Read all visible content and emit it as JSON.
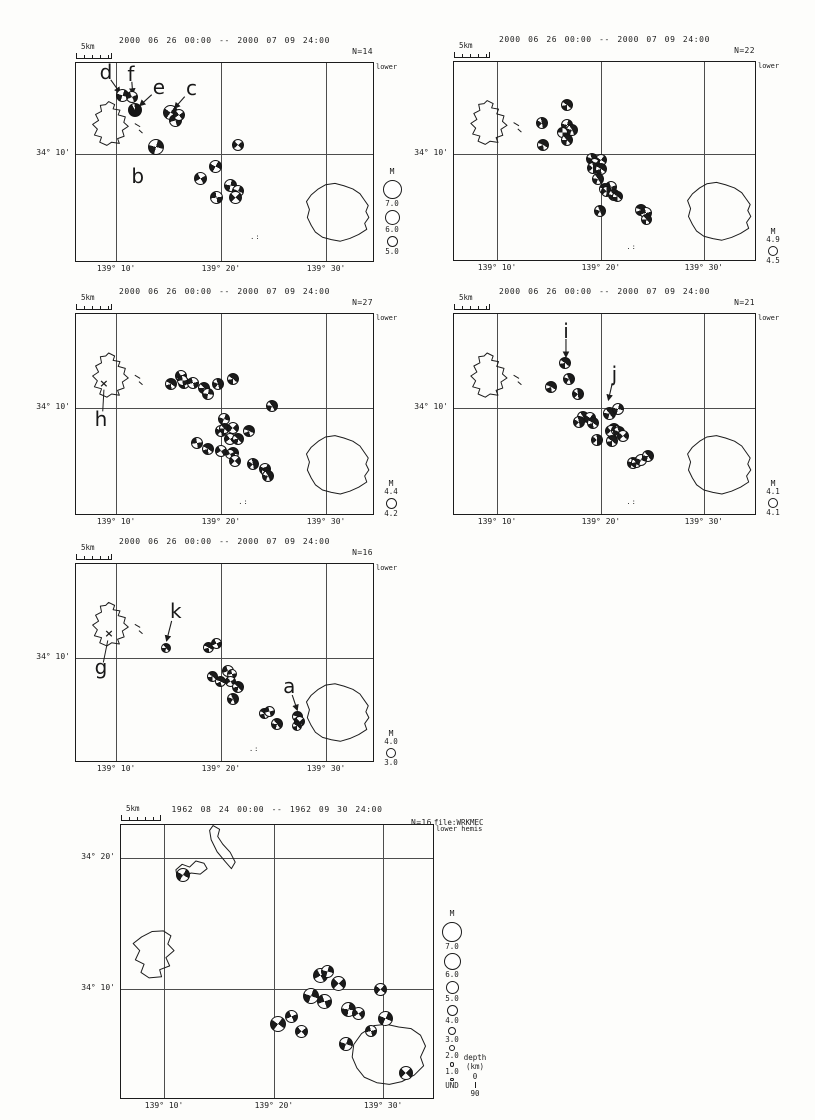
{
  "figure": {
    "ink_color": "#1c1c1c",
    "background_color": "#fdfdfb",
    "events_format": [
      "x_frac_of_frame",
      "y_frac_of_frame",
      "diameter_px",
      "rotation_deg",
      "style"
    ]
  },
  "panels": [
    {
      "id": "p1",
      "title": "2000 06 26 00:00 -- 2000 07 09 24:00",
      "count_label": "N=14",
      "hemisphere_label": "lower",
      "scalebar_label": "5km",
      "xticks": [
        {
          "f": 0.135,
          "label": "139° 10'"
        },
        {
          "f": 0.488,
          "label": "139° 20'"
        },
        {
          "f": 0.842,
          "label": "139° 30'"
        }
      ],
      "yticks": [
        {
          "f": 0.46,
          "label": "34° 10'"
        }
      ],
      "legend": {
        "style": "stack",
        "title": "M",
        "items": [
          {
            "label": "7.0",
            "d": 19
          },
          {
            "label": "6.0",
            "d": 15
          },
          {
            "label": "5.0",
            "d": 11
          }
        ]
      },
      "events": [
        [
          0.158,
          0.165,
          13,
          20,
          "q"
        ],
        [
          0.188,
          0.17,
          12,
          65,
          "q"
        ],
        [
          0.198,
          0.235,
          14,
          10,
          "d"
        ],
        [
          0.319,
          0.25,
          15,
          35,
          "q"
        ],
        [
          0.335,
          0.29,
          13,
          75,
          "q"
        ],
        [
          0.348,
          0.262,
          12,
          55,
          "q"
        ],
        [
          0.268,
          0.425,
          16,
          15,
          "q"
        ],
        [
          0.547,
          0.415,
          12,
          50,
          "q"
        ],
        [
          0.47,
          0.525,
          13,
          28,
          "q"
        ],
        [
          0.419,
          0.585,
          13,
          60,
          "q"
        ],
        [
          0.52,
          0.62,
          13,
          12,
          "q"
        ],
        [
          0.547,
          0.645,
          12,
          25,
          "q"
        ],
        [
          0.473,
          0.68,
          13,
          80,
          "q"
        ],
        [
          0.537,
          0.68,
          13,
          42,
          "q"
        ]
      ],
      "annotations": [
        {
          "letter": "d",
          "x": 0.101,
          "y": 0.05,
          "arrow": [
            0.117,
            0.085,
            0.148,
            0.15
          ]
        },
        {
          "letter": "f",
          "x": 0.185,
          "y": 0.062,
          "arrow": [
            0.188,
            0.095,
            0.191,
            0.155
          ]
        },
        {
          "letter": "e",
          "x": 0.279,
          "y": 0.128,
          "arrow": [
            0.255,
            0.16,
            0.215,
            0.215
          ]
        },
        {
          "letter": "c",
          "x": 0.389,
          "y": 0.132,
          "arrow": [
            0.366,
            0.17,
            0.332,
            0.228
          ]
        },
        {
          "letter": "b",
          "x": 0.208,
          "y": 0.578
        }
      ],
      "dots": {
        "glyph": ".:",
        "x": 0.604,
        "y": 0.885
      }
    },
    {
      "id": "p2",
      "title": "2000 06 26 00:00 -- 2000 07 09 24:00",
      "count_label": "N=22",
      "hemisphere_label": "lower",
      "scalebar_label": "5km",
      "xticks": [
        {
          "f": 0.143,
          "label": "139° 10'"
        },
        {
          "f": 0.488,
          "label": "139° 20'"
        },
        {
          "f": 0.83,
          "label": "139° 30'"
        }
      ],
      "yticks": [
        {
          "f": 0.465,
          "label": "34° 10'"
        }
      ],
      "legend": {
        "style": "bracket",
        "title": "M",
        "top": "4.9",
        "d": 10,
        "bottom": "4.5"
      },
      "events": [
        [
          0.375,
          0.215,
          12,
          30,
          "h"
        ],
        [
          0.293,
          0.31,
          12,
          70,
          "h"
        ],
        [
          0.375,
          0.32,
          12,
          15,
          "q"
        ],
        [
          0.391,
          0.345,
          12,
          55,
          "h"
        ],
        [
          0.359,
          0.355,
          11,
          90,
          "q"
        ],
        [
          0.375,
          0.395,
          12,
          40,
          "h"
        ],
        [
          0.296,
          0.42,
          12,
          20,
          "h"
        ],
        [
          0.457,
          0.49,
          12,
          65,
          "h"
        ],
        [
          0.49,
          0.495,
          12,
          35,
          "q"
        ],
        [
          0.468,
          0.515,
          11,
          55,
          "q"
        ],
        [
          0.461,
          0.535,
          12,
          80,
          "h"
        ],
        [
          0.49,
          0.54,
          12,
          25,
          "h"
        ],
        [
          0.477,
          0.59,
          12,
          50,
          "h"
        ],
        [
          0.523,
          0.63,
          12,
          70,
          "q"
        ],
        [
          0.5,
          0.64,
          12,
          10,
          "h"
        ],
        [
          0.508,
          0.655,
          11,
          85,
          "h"
        ],
        [
          0.533,
          0.67,
          12,
          45,
          "h"
        ],
        [
          0.543,
          0.68,
          11,
          30,
          "h"
        ],
        [
          0.484,
          0.755,
          12,
          60,
          "h"
        ],
        [
          0.622,
          0.745,
          12,
          20,
          "h"
        ],
        [
          0.638,
          0.765,
          12,
          75,
          "q"
        ],
        [
          0.641,
          0.795,
          11,
          40,
          "h"
        ]
      ],
      "annotations": [],
      "dots": {
        "glyph": ".:",
        "x": 0.59,
        "y": 0.94
      }
    },
    {
      "id": "p3",
      "title": "2000 06 26 00:00 -- 2000 07 09 24:00",
      "count_label": "N=27",
      "hemisphere_label": "lower",
      "scalebar_label": "5km",
      "xticks": [
        {
          "f": 0.135,
          "label": "139° 10'"
        },
        {
          "f": 0.488,
          "label": "139° 20'"
        },
        {
          "f": 0.842,
          "label": "139° 30'"
        }
      ],
      "yticks": [
        {
          "f": 0.47,
          "label": "34° 10'"
        }
      ],
      "legend": {
        "style": "bracket",
        "title": "M",
        "top": "4.4",
        "d": 11,
        "bottom": "4.2"
      },
      "events": [
        [
          0.319,
          0.35,
          12,
          25,
          "h"
        ],
        [
          0.352,
          0.31,
          12,
          60,
          "q"
        ],
        [
          0.362,
          0.345,
          12,
          15,
          "h"
        ],
        [
          0.36,
          0.33,
          11,
          85,
          "q"
        ],
        [
          0.393,
          0.345,
          12,
          75,
          "q"
        ],
        [
          0.43,
          0.37,
          12,
          40,
          "h"
        ],
        [
          0.443,
          0.4,
          12,
          10,
          "q"
        ],
        [
          0.477,
          0.35,
          12,
          65,
          "h"
        ],
        [
          0.527,
          0.325,
          12,
          30,
          "h"
        ],
        [
          0.661,
          0.46,
          12,
          50,
          "h"
        ],
        [
          0.497,
          0.525,
          12,
          20,
          "q"
        ],
        [
          0.487,
          0.585,
          12,
          70,
          "h"
        ],
        [
          0.5,
          0.57,
          11,
          38,
          "h"
        ],
        [
          0.527,
          0.57,
          12,
          45,
          "q"
        ],
        [
          0.581,
          0.585,
          12,
          15,
          "h"
        ],
        [
          0.52,
          0.625,
          12,
          55,
          "q"
        ],
        [
          0.547,
          0.625,
          12,
          35,
          "h"
        ],
        [
          0.409,
          0.645,
          12,
          80,
          "q"
        ],
        [
          0.443,
          0.675,
          12,
          25,
          "h"
        ],
        [
          0.487,
          0.685,
          12,
          60,
          "q"
        ],
        [
          0.53,
          0.695,
          12,
          10,
          "h"
        ],
        [
          0.52,
          0.7,
          10,
          62,
          "q"
        ],
        [
          0.537,
          0.735,
          12,
          45,
          "q"
        ],
        [
          0.597,
          0.75,
          12,
          70,
          "h"
        ],
        [
          0.638,
          0.775,
          12,
          30,
          "q"
        ],
        [
          0.64,
          0.79,
          10,
          18,
          "h"
        ],
        [
          0.648,
          0.81,
          12,
          55,
          "h"
        ]
      ],
      "annotations": [
        {
          "letter": "h",
          "x": 0.084,
          "y": 0.53,
          "cross_glyph": "×",
          "cross": {
            "x": 0.094,
            "y": 0.35
          },
          "line": [
            0.09,
            0.487,
            0.094,
            0.378
          ]
        }
      ],
      "dots": {
        "glyph": ".:",
        "x": 0.564,
        "y": 0.945
      }
    },
    {
      "id": "p4",
      "title": "2000 06 26 00:00 -- 2000 07 09 24:00",
      "count_label": "N=21",
      "hemisphere_label": "lower",
      "scalebar_label": "5km",
      "xticks": [
        {
          "f": 0.143,
          "label": "139° 10'"
        },
        {
          "f": 0.488,
          "label": "139° 20'"
        },
        {
          "f": 0.83,
          "label": "139° 30'"
        }
      ],
      "yticks": [
        {
          "f": 0.47,
          "label": "34° 10'"
        }
      ],
      "legend": {
        "style": "bracket",
        "title": "M",
        "top": "4.1",
        "d": 10,
        "bottom": "4.1"
      },
      "events": [
        [
          0.368,
          0.245,
          12,
          30,
          "h"
        ],
        [
          0.382,
          0.325,
          12,
          60,
          "h"
        ],
        [
          0.322,
          0.365,
          12,
          20,
          "h"
        ],
        [
          0.411,
          0.4,
          12,
          75,
          "h"
        ],
        [
          0.516,
          0.495,
          13,
          45,
          "h"
        ],
        [
          0.546,
          0.475,
          12,
          15,
          "q"
        ],
        [
          0.428,
          0.515,
          12,
          55,
          "h"
        ],
        [
          0.451,
          0.52,
          12,
          35,
          "q"
        ],
        [
          0.414,
          0.54,
          12,
          70,
          "h"
        ],
        [
          0.461,
          0.545,
          12,
          25,
          "h"
        ],
        [
          0.533,
          0.575,
          12,
          10,
          "h"
        ],
        [
          0.523,
          0.585,
          12,
          50,
          "q"
        ],
        [
          0.54,
          0.58,
          11,
          85,
          "q"
        ],
        [
          0.549,
          0.59,
          12,
          65,
          "h"
        ],
        [
          0.562,
          0.61,
          12,
          40,
          "q"
        ],
        [
          0.474,
          0.63,
          12,
          80,
          "h"
        ],
        [
          0.526,
          0.635,
          12,
          30,
          "h"
        ],
        [
          0.595,
          0.745,
          12,
          60,
          "h"
        ],
        [
          0.605,
          0.74,
          11,
          35,
          "h"
        ],
        [
          0.622,
          0.73,
          12,
          20,
          "q"
        ],
        [
          0.645,
          0.71,
          12,
          45,
          "h"
        ]
      ],
      "annotations": [
        {
          "letter": "i",
          "x": 0.372,
          "y": 0.09,
          "arrow": [
            0.372,
            0.125,
            0.372,
            0.215
          ]
        },
        {
          "letter": "j",
          "x": 0.533,
          "y": 0.305,
          "arrow": [
            0.526,
            0.345,
            0.513,
            0.43
          ]
        }
      ],
      "dots": {
        "glyph": ".:",
        "x": 0.59,
        "y": 0.945
      }
    },
    {
      "id": "p5",
      "title": "2000 06 26 00:00 -- 2000 07 09 24:00",
      "count_label": "N=16",
      "hemisphere_label": "lower",
      "scalebar_label": "5km",
      "xticks": [
        {
          "f": 0.135,
          "label": "139° 10'"
        },
        {
          "f": 0.488,
          "label": "139° 20'"
        },
        {
          "f": 0.842,
          "label": "139° 30'"
        }
      ],
      "yticks": [
        {
          "f": 0.477,
          "label": "34° 10'"
        }
      ],
      "legend": {
        "style": "bracket",
        "title": "M",
        "top": "4.0",
        "d": 10,
        "bottom": "3.0"
      },
      "events": [
        [
          0.302,
          0.426,
          10,
          40,
          "h"
        ],
        [
          0.446,
          0.426,
          11,
          20,
          "h"
        ],
        [
          0.473,
          0.406,
          11,
          65,
          "q"
        ],
        [
          0.46,
          0.569,
          11,
          30,
          "h"
        ],
        [
          0.513,
          0.543,
          12,
          70,
          "q"
        ],
        [
          0.525,
          0.558,
          10,
          80,
          "q"
        ],
        [
          0.487,
          0.594,
          11,
          15,
          "h"
        ],
        [
          0.52,
          0.594,
          11,
          55,
          "q"
        ],
        [
          0.547,
          0.624,
          12,
          35,
          "h"
        ],
        [
          0.53,
          0.685,
          12,
          60,
          "h"
        ],
        [
          0.634,
          0.761,
          11,
          25,
          "h"
        ],
        [
          0.651,
          0.751,
          11,
          75,
          "q"
        ],
        [
          0.678,
          0.812,
          12,
          45,
          "h"
        ],
        [
          0.745,
          0.772,
          11,
          10,
          "h"
        ],
        [
          0.752,
          0.797,
          11,
          50,
          "q"
        ],
        [
          0.745,
          0.822,
          10,
          30,
          "h"
        ]
      ],
      "annotations": [
        {
          "letter": "k",
          "x": 0.336,
          "y": 0.244,
          "arrow": [
            0.322,
            0.289,
            0.305,
            0.39
          ]
        },
        {
          "letter": "g",
          "x": 0.084,
          "y": 0.528,
          "cross_glyph": "×",
          "cross": {
            "x": 0.111,
            "y": 0.355
          },
          "line": [
            0.092,
            0.5,
            0.107,
            0.388
          ]
        },
        {
          "letter": "a",
          "x": 0.718,
          "y": 0.624,
          "arrow": [
            0.728,
            0.665,
            0.745,
            0.742
          ]
        }
      ],
      "dots": {
        "glyph": ".:",
        "x": 0.6,
        "y": 0.945
      }
    },
    {
      "id": "p6",
      "title": "1962 08 24 00:00 -- 1962 09 30 24:00",
      "count_label": "N=16",
      "file_label": "file:WRKMEC",
      "hemisphere_label": "lower hemis",
      "scalebar_label": "5km",
      "xticks": [
        {
          "f": 0.138,
          "label": "139° 10'"
        },
        {
          "f": 0.49,
          "label": "139° 20'"
        },
        {
          "f": 0.84,
          "label": "139° 30'"
        }
      ],
      "yticks": [
        {
          "f": 0.121,
          "label": "34° 20'"
        },
        {
          "f": 0.601,
          "label": "34° 10'"
        }
      ],
      "legend": {
        "style": "stack",
        "title": "M",
        "items": [
          {
            "label": "7.0",
            "d": 20
          },
          {
            "label": "6.0",
            "d": 17
          },
          {
            "label": "5.0",
            "d": 13
          },
          {
            "label": "4.0",
            "d": 11
          },
          {
            "label": "3.0",
            "d": 8
          },
          {
            "label": "2.0",
            "d": 6
          },
          {
            "label": "1.0",
            "d": 4.5
          },
          {
            "label": "UND",
            "d": 3.5
          }
        ],
        "depth": {
          "title": "depth",
          "unit": "(km)",
          "top": "0",
          "bottom": "90"
        }
      },
      "events": [
        [
          0.199,
          0.183,
          14,
          30,
          "q"
        ],
        [
          0.641,
          0.553,
          15,
          60,
          "q"
        ],
        [
          0.663,
          0.535,
          13,
          15,
          "q"
        ],
        [
          0.696,
          0.582,
          15,
          45,
          "q"
        ],
        [
          0.609,
          0.626,
          16,
          20,
          "q"
        ],
        [
          0.651,
          0.645,
          15,
          70,
          "q"
        ],
        [
          0.833,
          0.601,
          13,
          40,
          "q"
        ],
        [
          0.728,
          0.674,
          15,
          10,
          "q"
        ],
        [
          0.76,
          0.692,
          13,
          55,
          "q"
        ],
        [
          0.545,
          0.7,
          13,
          65,
          "q"
        ],
        [
          0.503,
          0.729,
          16,
          35,
          "q"
        ],
        [
          0.849,
          0.707,
          15,
          25,
          "q"
        ],
        [
          0.577,
          0.755,
          13,
          50,
          "q"
        ],
        [
          0.801,
          0.755,
          12,
          75,
          "q"
        ],
        [
          0.721,
          0.802,
          14,
          20,
          "q"
        ],
        [
          0.913,
          0.908,
          14,
          45,
          "q"
        ]
      ],
      "annotations": []
    }
  ]
}
